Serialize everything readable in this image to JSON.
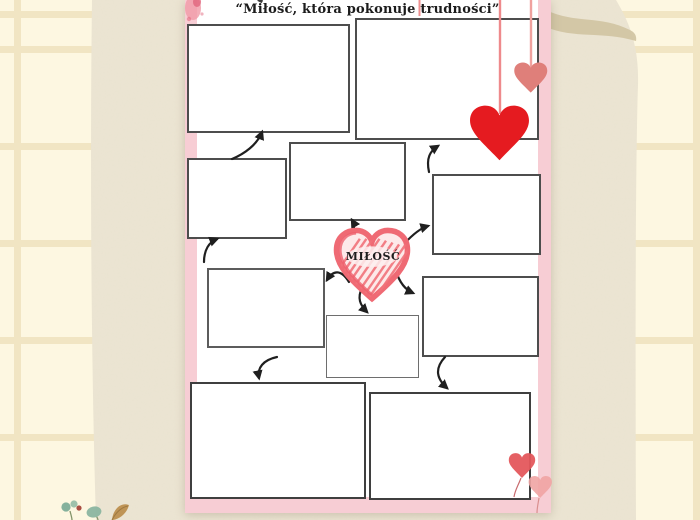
{
  "page": {
    "title": "“Miłość, która pokonuje trudności”",
    "center_label": "MIŁOŚĆ"
  },
  "worksheet": {
    "description_visible": "mind-map graphic organizer with empty answer boxes connected by hand-drawn arrows to a central scribbled heart",
    "boxes": [
      {
        "id": "top-left",
        "text": ""
      },
      {
        "id": "top-right",
        "text": ""
      },
      {
        "id": "left-middle",
        "text": ""
      },
      {
        "id": "center-upper",
        "text": ""
      },
      {
        "id": "right-middle",
        "text": ""
      },
      {
        "id": "left-lower",
        "text": ""
      },
      {
        "id": "center-small",
        "text": ""
      },
      {
        "id": "right-lower",
        "text": ""
      },
      {
        "id": "bottom-left",
        "text": ""
      },
      {
        "id": "bottom-right",
        "text": ""
      }
    ]
  },
  "decorations": {
    "center_heart": "scribble-heart",
    "hanging_hearts": [
      "big-red-heart-on-string",
      "small-salmon-heart-on-string",
      "extra-string"
    ],
    "balloon_hearts": [
      "red-heart-balloon",
      "pink-heart-balloon"
    ],
    "plant": "watercolor-sprig",
    "paint_smudge": "pink-watercolor-smudge-top-left"
  },
  "colors": {
    "background": "#fdf7e1",
    "grid_line": "#f1e5c3",
    "paper": "#ece5d3",
    "paper_band": "#d2c5a3",
    "page_pink": "#f7cdd4",
    "page_white": "#ffffff",
    "box_border": "#4d4d4d",
    "arrow": "#1f1f1f",
    "heart_red": "#e51b20",
    "heart_salmon": "#df7f7a",
    "scribble_pink": "#ef6a74",
    "title_text": "#1c1c1c"
  }
}
